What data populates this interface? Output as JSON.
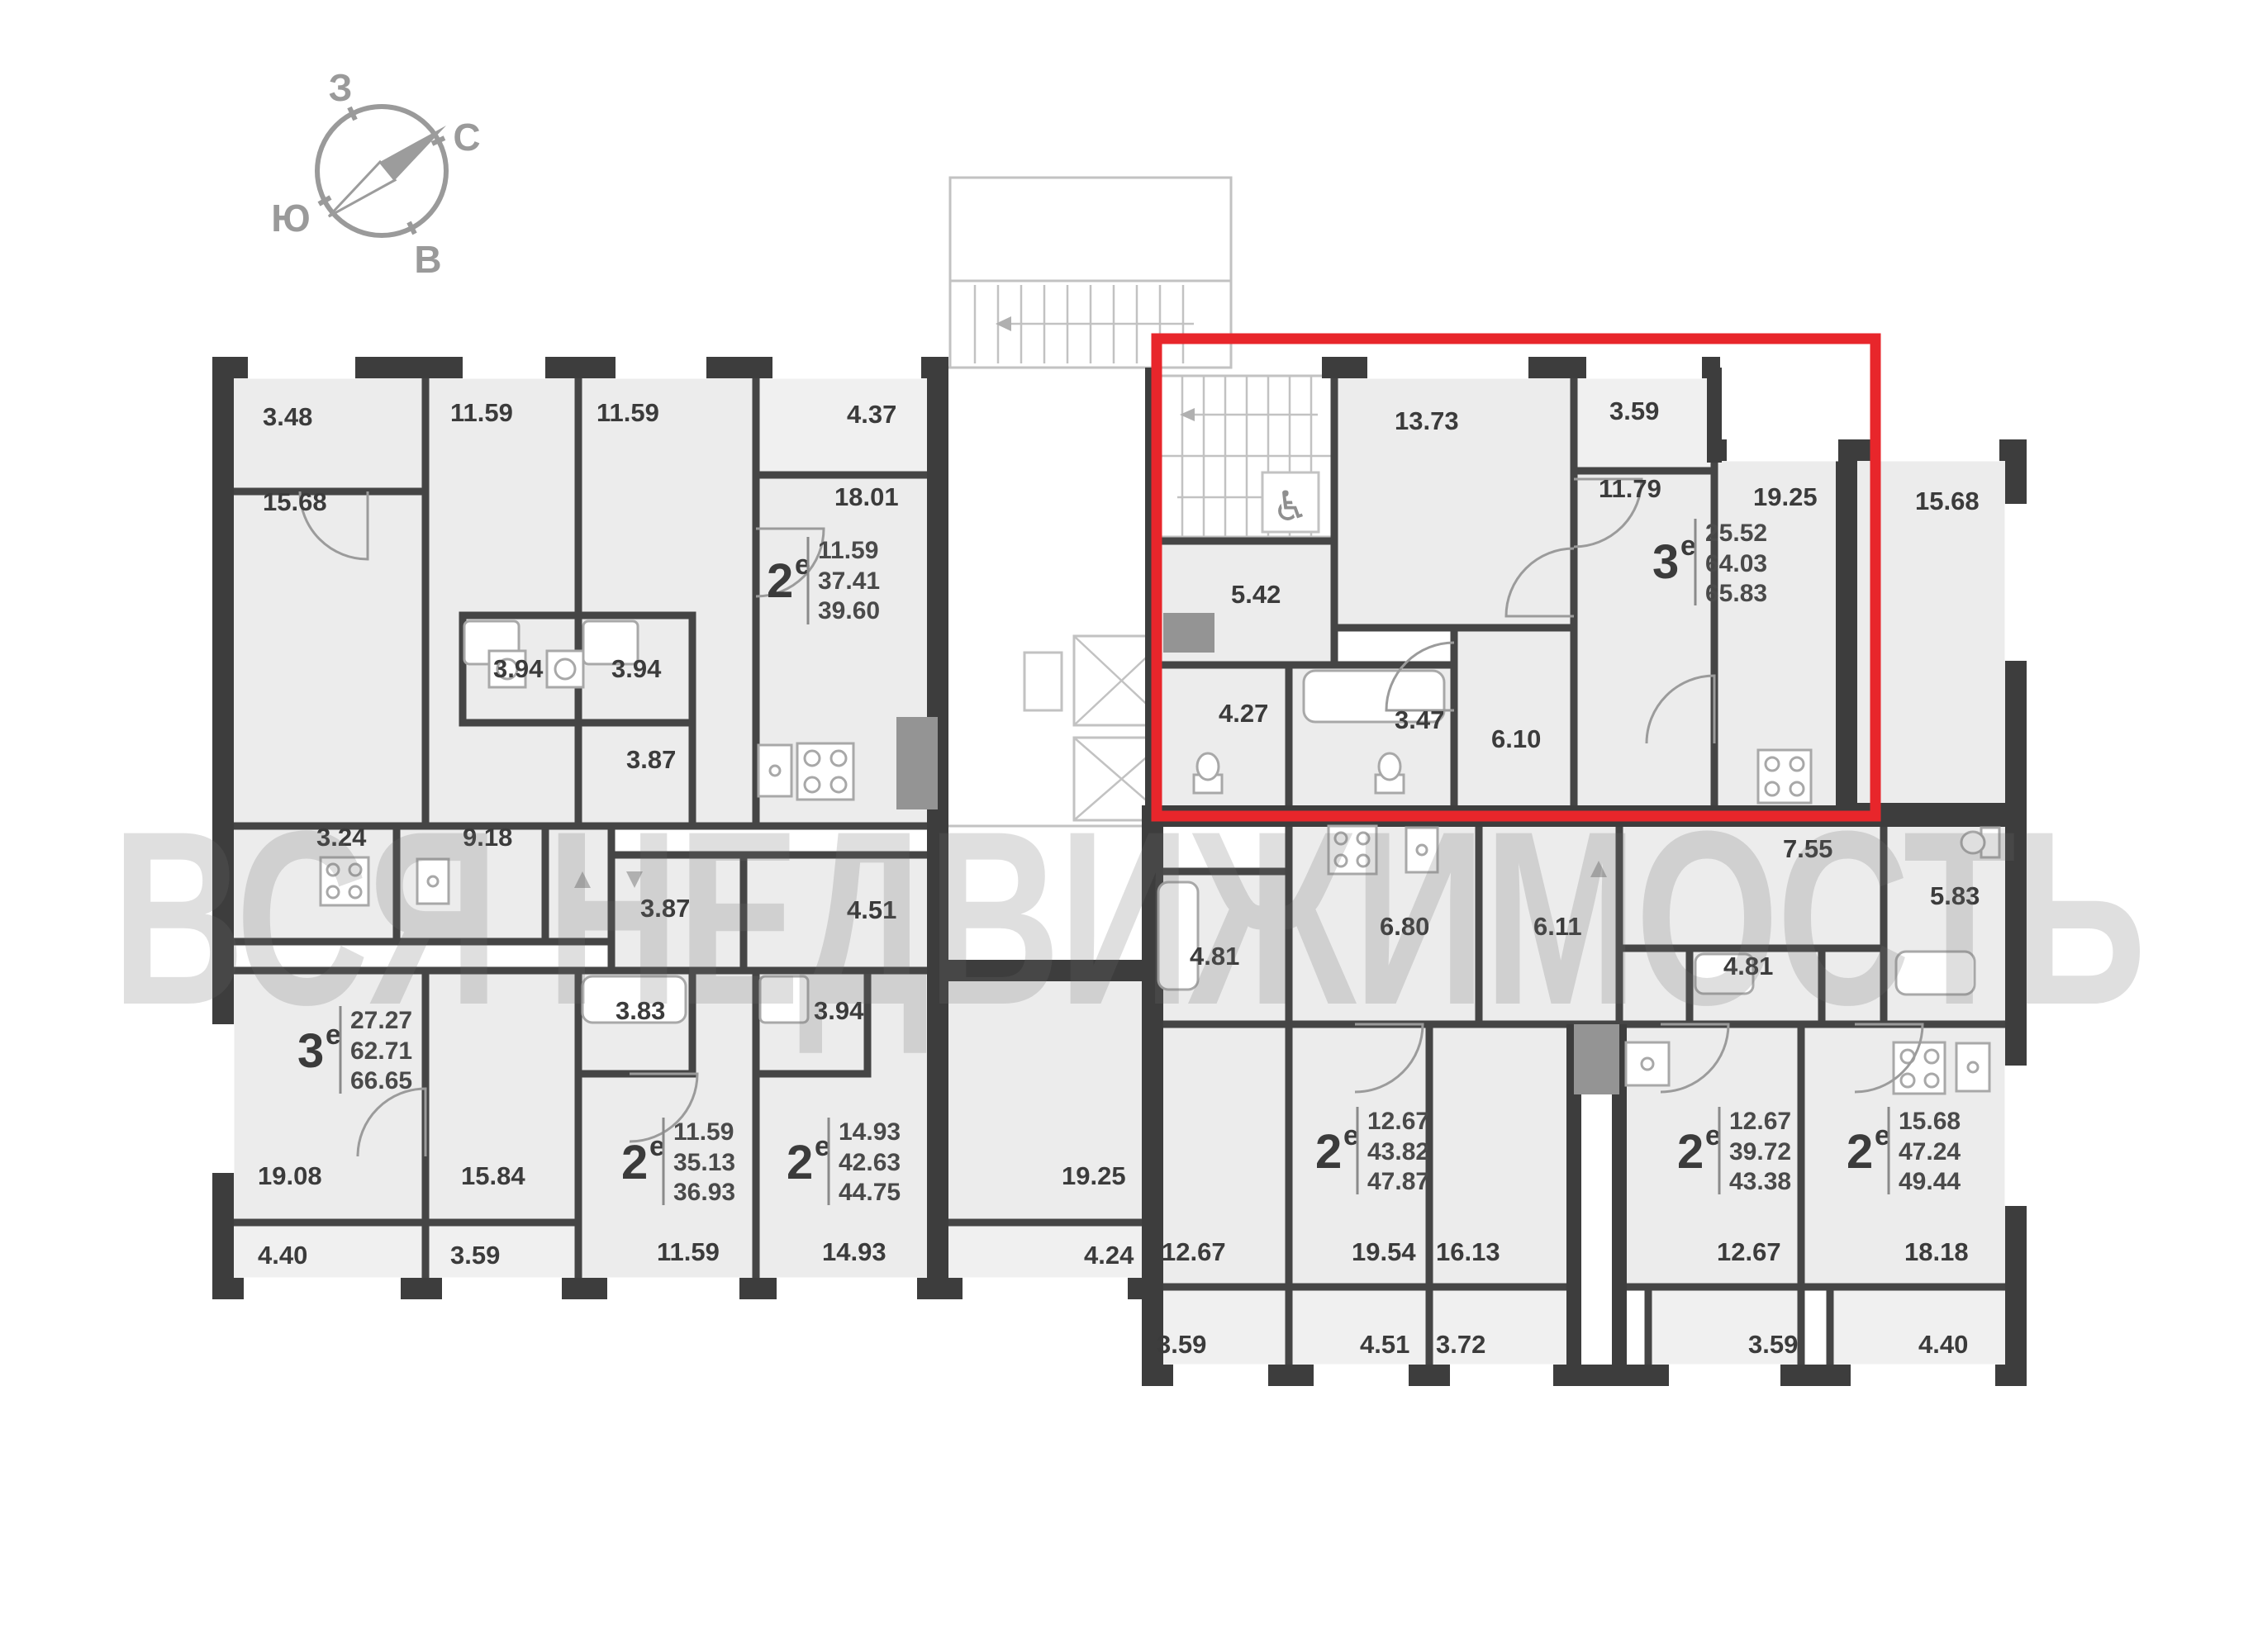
{
  "watermark": {
    "text": "ВСЯ НЕДВИЖИМОСТЬ"
  },
  "compass": {
    "west": "З",
    "north": "С",
    "south": "Ю",
    "east": "В"
  },
  "colors": {
    "highlight": "#e8262b",
    "walls": "#3d3d3d",
    "room_fill": "#ececec"
  },
  "icons": {
    "wheelchair": "♿"
  },
  "areas": {
    "tl1": "3.48",
    "tl2": "15.68",
    "tl3": "11.59",
    "tl4": "11.59",
    "tl5": "4.37",
    "tl6": "18.01",
    "tl7": "3.94",
    "tl8": "3.94",
    "tl9": "3.87",
    "ml1": "3.24",
    "ml2": "9.18",
    "ml3": "3.87",
    "ml4": "4.51",
    "bl1": "19.08",
    "bl2": "4.40",
    "bl3": "15.84",
    "bl4": "3.59",
    "bl5": "3.83",
    "bl6": "11.59",
    "bl7": "3.94",
    "bl8": "14.93",
    "mc1": "19.25",
    "mc2": "4.24",
    "hl1": "13.73",
    "hl2": "3.59",
    "hl3": "11.79",
    "hl4": "19.25",
    "hl5": "5.42",
    "hl6": "4.27",
    "hl7": "3.47",
    "hl8": "6.10",
    "rt1": "15.68",
    "rm1": "6.80",
    "rm2": "6.11",
    "rm3": "7.55",
    "rm4": "4.81",
    "rm5": "4.81",
    "rm6": "5.83",
    "mb1": "12.67",
    "mb2": "3.59",
    "mb3": "19.54",
    "mb4": "16.13",
    "mb5": "4.51",
    "mb6": "3.72",
    "mb7": "12.67",
    "mb8": "3.59",
    "mb9": "18.18",
    "mb10": "4.40"
  },
  "apartments": [
    {
      "number": "2",
      "suffix": "е",
      "rooms": "11.59",
      "living": "37.41",
      "total": "39.60"
    },
    {
      "number": "3",
      "suffix": "е",
      "rooms": "25.52",
      "living": "64.03",
      "total": "65.83"
    },
    {
      "number": "3",
      "suffix": "е",
      "rooms": "27.27",
      "living": "62.71",
      "total": "66.65"
    },
    {
      "number": "2",
      "suffix": "е",
      "rooms": "11.59",
      "living": "35.13",
      "total": "36.93"
    },
    {
      "number": "2",
      "suffix": "е",
      "rooms": "14.93",
      "living": "42.63",
      "total": "44.75"
    },
    {
      "number": "2",
      "suffix": "е",
      "rooms": "12.67",
      "living": "43.82",
      "total": "47.87"
    },
    {
      "number": "2",
      "suffix": "е",
      "rooms": "12.67",
      "living": "39.72",
      "total": "43.38"
    },
    {
      "number": "2",
      "suffix": "е",
      "rooms": "15.68",
      "living": "47.24",
      "total": "49.44"
    }
  ]
}
